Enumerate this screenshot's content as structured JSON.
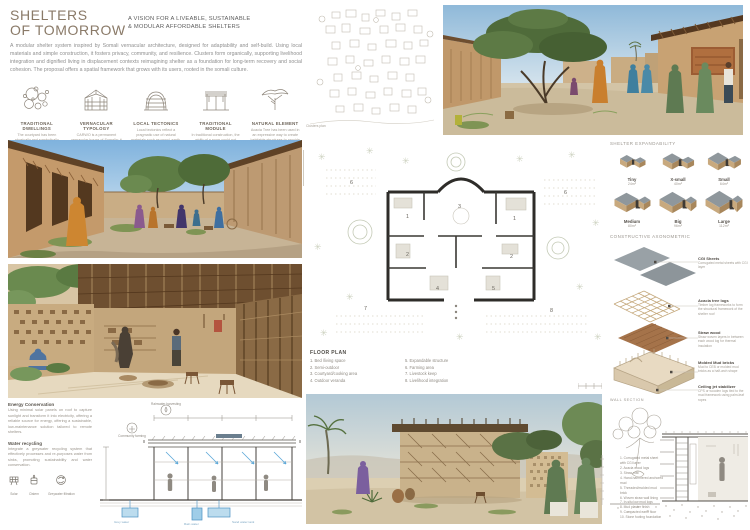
{
  "board": {
    "title_line1": "SHELTERS",
    "title_line2": "OF TOMORROW",
    "subtitle_line1": "A VISION FOR A LIVEABLE, SUSTAINABLE",
    "subtitle_line2": "& MODULAR AFFORDABLE SHELTERS",
    "intro": "A modular shelter system inspired by Somali vernacular architecture, designed for adaptability and self-build. Using local materials and simple construction, it fosters privacy, community, and resilience. Clusters form organically, supporting livelihood integration and dignified living in displacement contexts reimagining shelter as a foundation for long-term recovery and social cohesion. The proposal offers a spatial framework that grows with its users, rooted in the somali culture."
  },
  "colors": {
    "title_brown": "#8a7a68",
    "earth_tan": "#c8a97e",
    "roof_gray": "#8f979c",
    "sky_blue": "#9cc2dd",
    "annotation_blue": "#5aa7d8"
  },
  "concepts": [
    {
      "title": "TRADITIONAL DWELLINGS",
      "caption": "The courtyard has been physically and symbolically adapted to serve functions in shelter climate."
    },
    {
      "title": "VERNACULAR TYPOLOGY",
      "caption": "CARWO is a permanent vernacular house of Somalia; it has a rectangular plan and flat mat roofs."
    },
    {
      "title": "LOCAL TECTONICS",
      "caption": "Local tectonics reflect a pragmatic use of natural materials such as wood, earth, and woven textiles that respond to climate and cultural patterns of nomadic life."
    },
    {
      "title": "TRADITIONAL MODULE",
      "caption": "In traditional construction, the width of a room could not exceed 3.00 m without a wooden beam more than 3 m in length."
    },
    {
      "title": "NATURAL ELEMENT",
      "caption": "Acacia Tree has been used in an expressive way to create habitable structures to provide shelter."
    }
  ],
  "site_plan": {
    "caption": "Clusters plan"
  },
  "expandability": {
    "heading": "SHELTER EXPANDABILITY",
    "sizes": [
      {
        "name": "Tiny",
        "area": "24m²"
      },
      {
        "name": "X-small",
        "area": "40m²"
      },
      {
        "name": "Small",
        "area": "64m²"
      },
      {
        "name": "Medium",
        "area": "80m²"
      },
      {
        "name": "Big",
        "area": "96m²"
      },
      {
        "name": "Large",
        "area": "112m²"
      }
    ]
  },
  "axonometric": {
    "heading": "CONSTRUCTIVE AXONOMETRIC",
    "layers": [
      {
        "name": "CGI Sheets",
        "note": "Corrugated metal sheets with CGI layer"
      },
      {
        "name": "Acacia tree logs",
        "note": "Timber log frameworks to form the structural framework of the shelter roof"
      },
      {
        "name": "Straw wood",
        "note": "Straw woven layers in between each wood log for thermal insulation"
      },
      {
        "name": "Molded Mud bricks",
        "note": "Mud to CEB or molded mud bricks as a half-arch shape"
      },
      {
        "name": "Ceiling jet stabilizer",
        "note": "CPS or wooden logs tied to the mud framework using palm-leaf ropes"
      }
    ]
  },
  "floor_plan": {
    "heading": "FLOOR PLAN",
    "legend": [
      "1. Bed /living space",
      "2. Semi-outdoor",
      "3. Courtyard/cooking area",
      "4. Outdoor veranda",
      "5. Expandable structure",
      "6. Farming area",
      "7. Livestock keep",
      "8. Livelihood integration"
    ]
  },
  "sustainability": {
    "energy_title": "Energy Conservation",
    "energy_text": "Using minimal solar panels on roof to capture sunlight and transform it into electricity, offering a reliable source for energy, offering a sustainable, low-maintenance solution tailored to remote shelters.",
    "water_title": "Water recycling",
    "water_text": "Integrate a greywater recycling system that effectively processes and re-purposes water from sinks, promoting sustainability and water conservation.",
    "icons": [
      {
        "label": "Solar"
      },
      {
        "label": "Cistern"
      },
      {
        "label": "Greywater filtration"
      }
    ],
    "section_icons": [
      {
        "label": "Rainwater harvesting"
      },
      {
        "label": "Community farming"
      }
    ],
    "tanks": [
      "Grey water",
      "Rain water",
      "Sand water tank"
    ]
  },
  "wall_section": {
    "heading": "WALL SECTION",
    "items": [
      "1. Corrugated metal sheet with CGI layer",
      "2. Acacia wood logs",
      "3. Straw mat",
      "4. Hand-hammered anchored mud",
      "5. Threaded/molded mud brick",
      "6. Woven straw wall lining",
      "7. In-situ low mud logs",
      "8. Mud plaster finish",
      "9. Compacted earth floor",
      "10. Stone footing foundation"
    ]
  }
}
